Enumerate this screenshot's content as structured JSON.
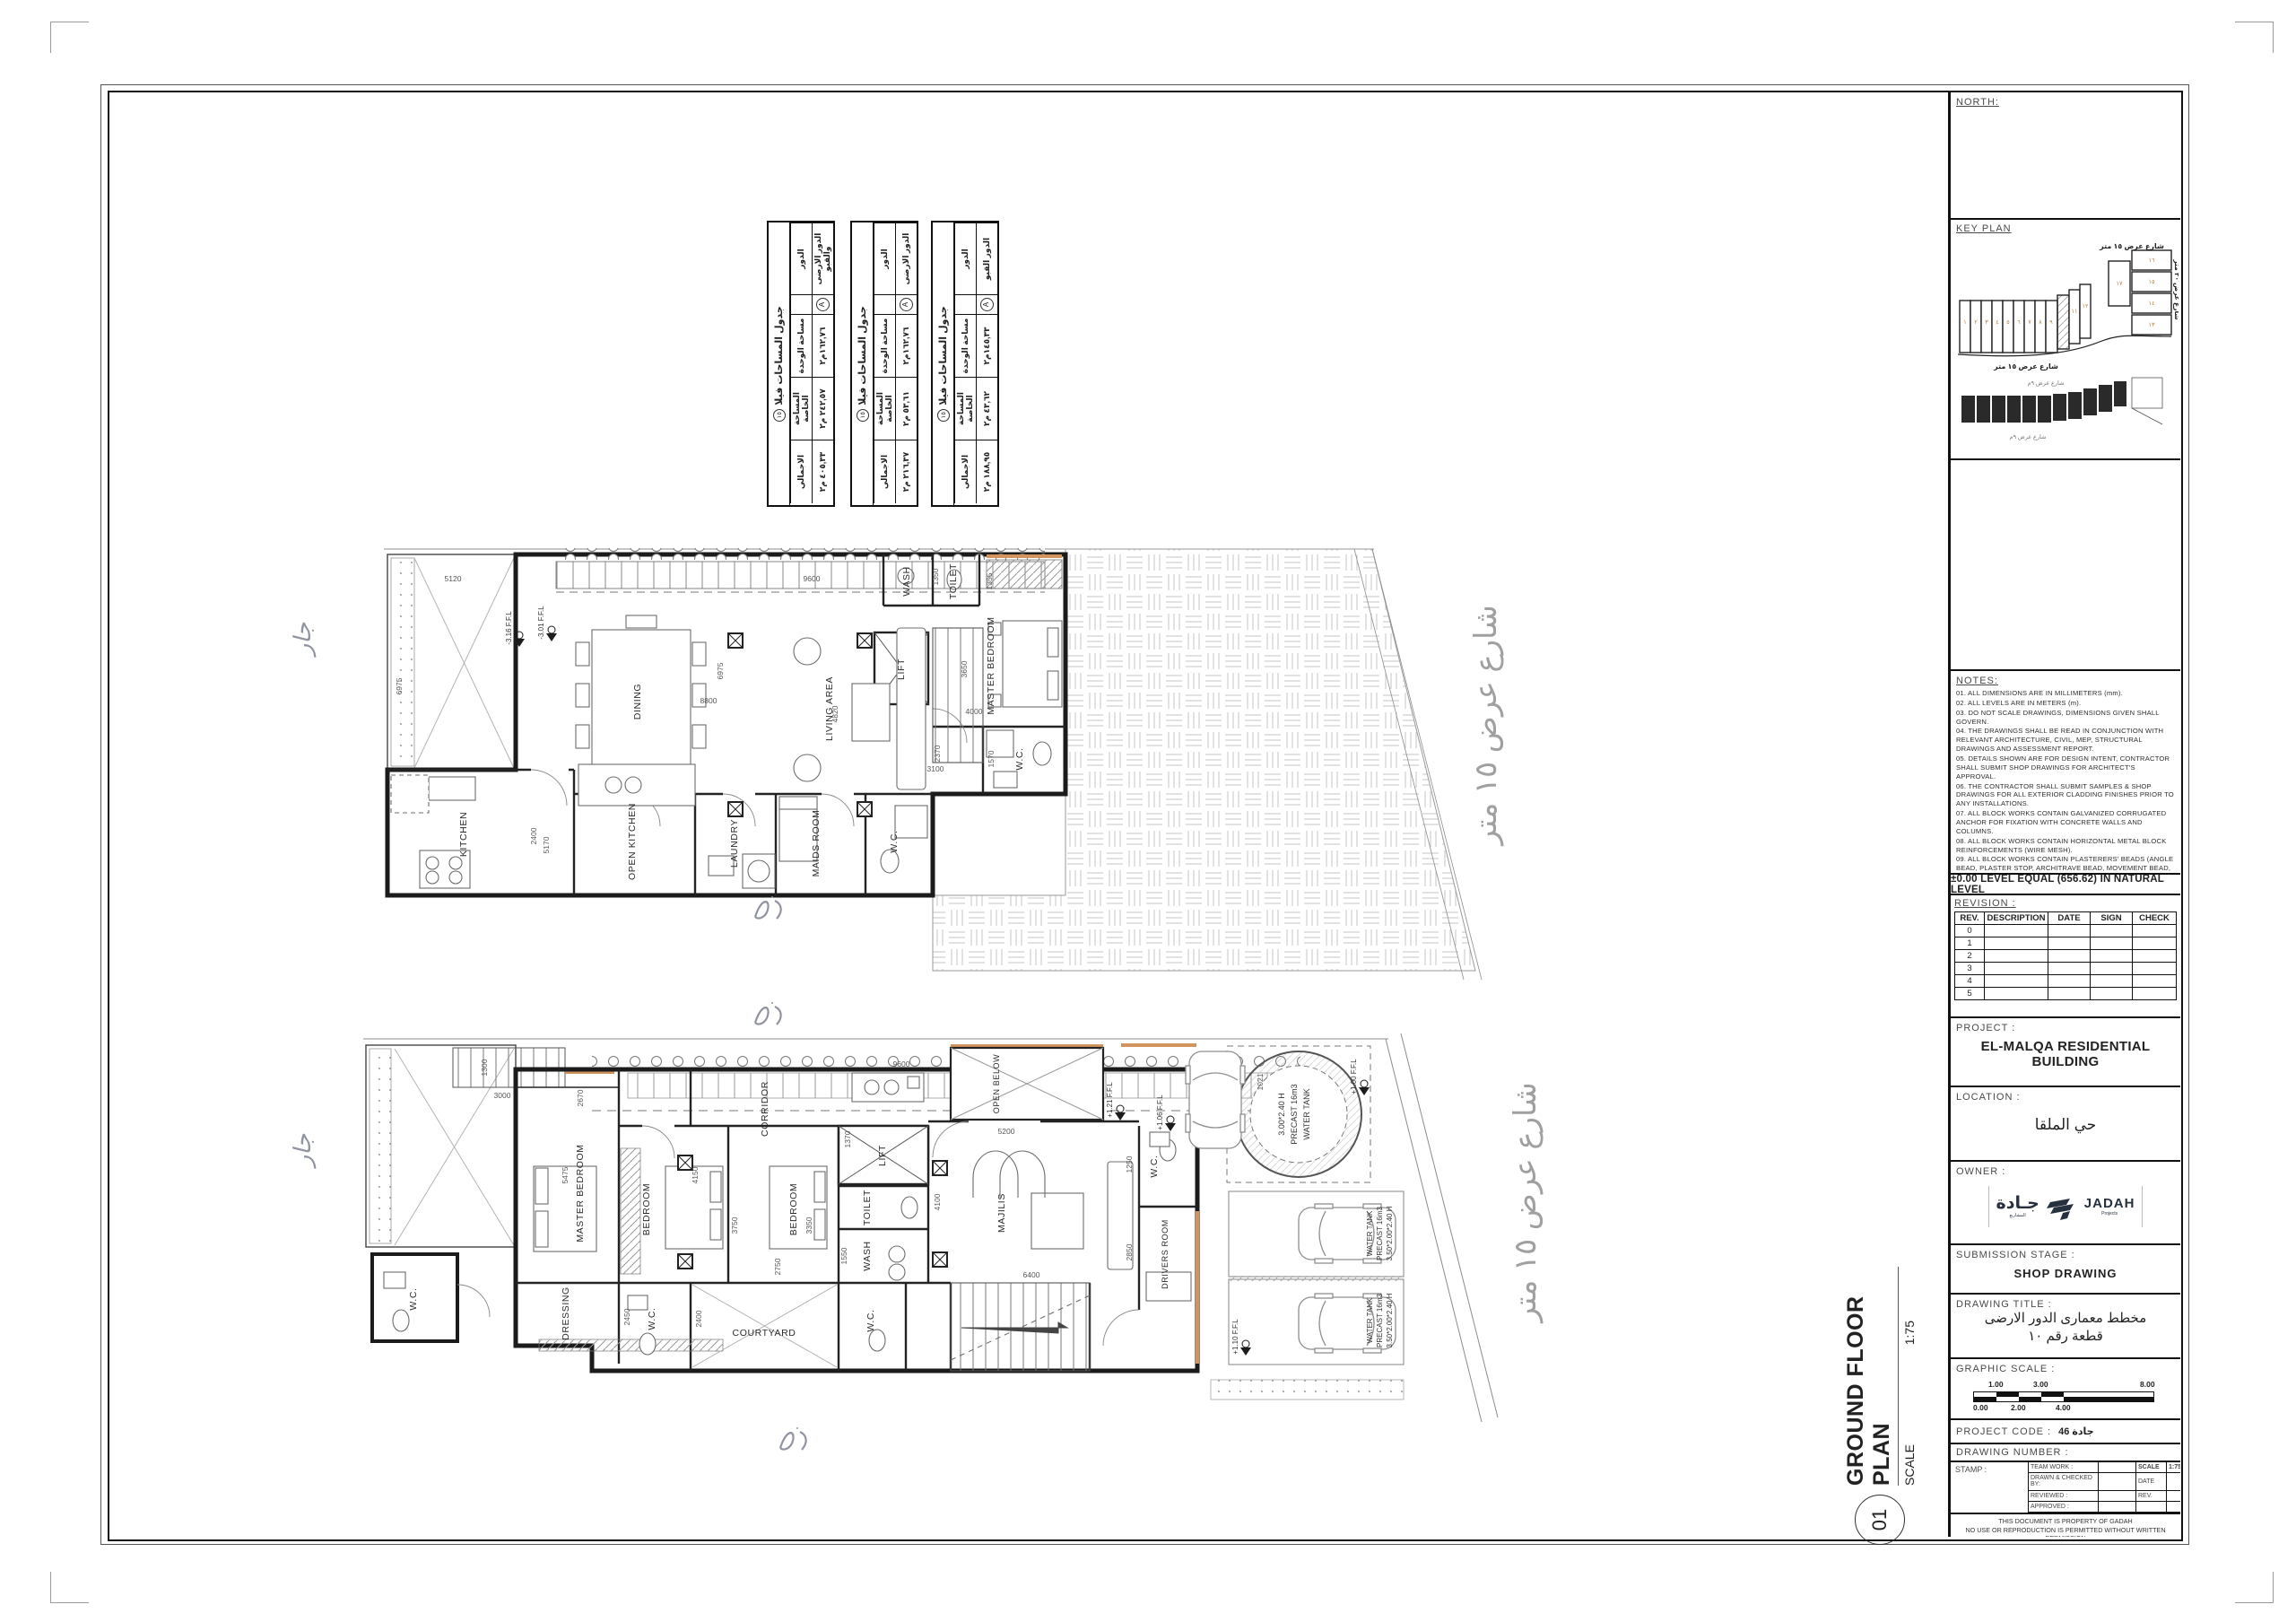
{
  "sheet": {
    "neighbor_label": "جار",
    "plan_label": {
      "number": "01",
      "title": "GROUND FLOOR PLAN",
      "scale_label": "SCALE",
      "scale_value": "1:75"
    }
  },
  "area_tables": {
    "title": "جدول المساحات فيلا",
    "badge": "١٥",
    "headers": {
      "floor": "الدور",
      "unit": "مساحة الوحدة",
      "private": "المساحة الخاصة",
      "total": "الاجمالي"
    },
    "unit_mark": "A",
    "tables": [
      {
        "floor": "الدور الارضى والقبو",
        "unit": "١٦٢,٧٦م٢",
        "private": "٢٤٢,٥٧ م٢",
        "total": "٤٠٥,٣٣ م٢"
      },
      {
        "floor": "الدور الارضى",
        "unit": "١٦٢,٧٦م٢",
        "private": "٥٣,٦١ م٢",
        "total": "٢١٦,٣٧ م٢"
      },
      {
        "floor": "الدور القبو",
        "unit": "١٤٥,٣٣م٢",
        "private": "٤٣,٦٢ م٢",
        "total": "١٨٨,٩٥ م٢"
      }
    ]
  },
  "plan_top": {
    "street": "شارع عرض ١٥ متر",
    "rooms": [
      "KITCHEN",
      "OPEN KITCHEN",
      "DINING",
      "LIVING AREA",
      "LAUNDRY",
      "MAIDS ROOM",
      "W.C.",
      "LIFT",
      "WASH",
      "TOILET",
      "MASTER BEDROOM",
      "W.C."
    ],
    "dims": [
      "5120",
      "9600",
      "6975",
      "6975",
      "8800",
      "4820",
      "2370",
      "3100",
      "2400",
      "5170",
      "1355",
      "4000",
      "3650",
      "1570",
      "1350"
    ],
    "levels": [
      "-3.16 F.F.L",
      "-3.01 F.F.L"
    ]
  },
  "plan_bottom": {
    "street": "شارع عرض ١٥ متر",
    "rooms": [
      "MASTER BEDROOM",
      "DRESSING",
      "W.C.",
      "BEDROOM",
      "BEDROOM",
      "CORRIDOR",
      "COURTYARD",
      "W.C.",
      "LIFT",
      "TOILET",
      "WASH",
      "MAJILIS",
      "W.C.",
      "DRIVERS ROOM",
      "OPEN BELOW",
      "W.C."
    ],
    "dims": [
      "1300",
      "3000",
      "2670",
      "9600",
      "5200",
      "5475",
      "4150",
      "3750",
      "3350",
      "2750",
      "1370",
      "4100",
      "6400",
      "2850",
      "1250",
      "2450",
      "2400",
      "1550",
      "1021"
    ],
    "levels": [
      "+1.21 F.F.L",
      "+1.06 F.F.L",
      "+1.00 F.F.L",
      "+1.10 F.F.L"
    ],
    "water_tank": [
      "3.00*2.40 H",
      "PRECAST 16m3",
      "WATER TANK"
    ],
    "parking": [
      "WATER TANK",
      "PRECAST 16m3",
      "3.50*2.00*2.40 H"
    ]
  },
  "title_block": {
    "north_label": "NORTH:",
    "key_plan": {
      "label": "KEY PLAN",
      "street_15": "شارع عرض ١٥ متر",
      "street_20": "شارع عرض ٢٠ متر",
      "street_9": "شارع عرض ٩م",
      "lots_row": [
        "١",
        "٢",
        "٣",
        "٤",
        "٥",
        "٦",
        "٧",
        "٨",
        "٩"
      ],
      "lots_mid": [
        "١١",
        "١٢"
      ],
      "lots_col": [
        "١٦",
        "١٥",
        "١٤",
        "١٣"
      ],
      "lot_corner": "١٧"
    },
    "notes_label": "NOTES:",
    "notes": [
      "01. ALL DIMENSIONS ARE IN MILLIMETERS (mm).",
      "02. ALL LEVELS ARE IN METERS (m).",
      "03. DO NOT SCALE DRAWINGS, DIMENSIONS GIVEN SHALL GOVERN.",
      "04. THE DRAWINGS SHALL BE READ IN CONJUNCTION WITH RELEVANT ARCHITECTURE, CIVIL, MEP, STRUCTURAL DRAWINGS AND ASSESSMENT REPORT.",
      "05. DETAILS SHOWN ARE FOR DESIGN INTENT, CONTRACTOR SHALL SUBMIT SHOP DRAWINGS FOR ARCHITECT'S APPROVAL.",
      "06. THE CONTRACTOR SHALL SUBMIT SAMPLES & SHOP DRAWINGS FOR ALL EXTERIOR CLADDING FINISHES PRIOR TO ANY INSTALLATIONS.",
      "07. ALL BLOCK WORKS CONTAIN GALVANIZED CORRUGATED ANCHOR FOR FIXATION WITH CONCRETE WALLS AND COLUMNS.",
      "08. ALL BLOCK WORKS CONTAIN HORIZONTAL METAL BLOCK REINFORCEMENTS (WIRE MESH).",
      "09. ALL BLOCK WORKS CONTAIN PLASTERERS' BEADS (ANGLE BEAD, PLASTER STOP, ARCHITRAVE BEAD, MOVEMENT BEAD, EXPANDED METAL LATH,......)",
      "10. ALL BLOCK WALLS BETWEEN FIRE ZONES AND CORE CORRIDOR SHALL BE FIRE RESISTANT."
    ],
    "level_note": "±0.00 LEVEL EQUAL (656.62) IN NATURAL LEVEL",
    "revision": {
      "label": "REVISION :",
      "headers": [
        "REV.",
        "DESCRIPTION",
        "DATE",
        "SIGN",
        "CHECK"
      ],
      "rows": [
        "0",
        "1",
        "2",
        "3",
        "4",
        "5"
      ]
    },
    "project": {
      "label": "PROJECT :",
      "value": "EL-MALQA RESIDENTIAL BUILDING"
    },
    "location": {
      "label": "LOCATION :",
      "value": "حي الملقا"
    },
    "owner": {
      "label": "OWNER :",
      "logo_ar": "جـادة",
      "logo_ar_sub": "المشاريع",
      "logo_en": "JADAH",
      "logo_en_sub": "Projects"
    },
    "submission": {
      "label": "SUBMISSION STAGE :",
      "value": "SHOP DRAWING"
    },
    "drawing_title": {
      "label": "DRAWING TITLE :",
      "line1": "مخطط معمارى الدور الارضى",
      "line2": "قطعة رقم ١٠"
    },
    "graphic_scale": {
      "label": "GRAPHIC SCALE :",
      "top": [
        "1.00",
        "3.00",
        "8.00"
      ],
      "bottom": [
        "0.00",
        "2.00",
        "4.00"
      ]
    },
    "project_code": {
      "label": "PROJECT CODE :",
      "value": "جادة 46"
    },
    "drawing_number_label": "DRAWING NUMBER :",
    "stamp": {
      "label": "STAMP :",
      "team": "TEAM WORK :",
      "scale_key": "SCALE",
      "scale_val": "1:75",
      "drawn": "DRAWN & CHECKED BY:",
      "date": "DATE",
      "reviewed": "REVIEWED :",
      "rev": "REV.",
      "approved": "APPROVED :"
    },
    "disclaimer1": "THIS DOCUMENT IS PROPERTY OF GADAH",
    "disclaimer2": "NO USE OR REPRODUCTION IS PERMITTED WITHOUT WRITTEN PERMISSION"
  }
}
